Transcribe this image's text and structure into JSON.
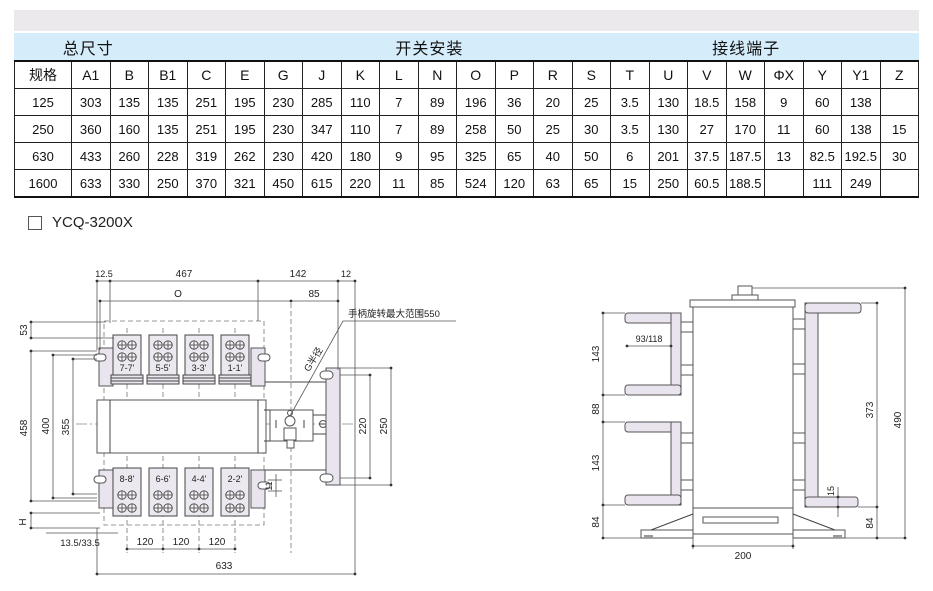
{
  "colors": {
    "header_band_blue": "#d5ecfb",
    "top_strip_gray": "#ece9ec",
    "drawing_fill_lavender": "#e9e4ee",
    "table_border": "#222222"
  },
  "table": {
    "groups": [
      "总尺寸",
      "开关安装",
      "接线端子"
    ],
    "columns": [
      "规格",
      "A1",
      "B",
      "B1",
      "C",
      "E",
      "G",
      "J",
      "K",
      "L",
      "N",
      "O",
      "P",
      "R",
      "S",
      "T",
      "U",
      "V",
      "W",
      "ΦX",
      "Y",
      "Y1",
      "Z"
    ],
    "rows": [
      [
        "125",
        "303",
        "135",
        "135",
        "251",
        "195",
        "230",
        "285",
        "110",
        "7",
        "89",
        "196",
        "36",
        "20",
        "25",
        "3.5",
        "130",
        "18.5",
        "158",
        "9",
        "60",
        "138",
        ""
      ],
      [
        "250",
        "360",
        "160",
        "135",
        "251",
        "195",
        "230",
        "347",
        "110",
        "7",
        "89",
        "258",
        "50",
        "25",
        "30",
        "3.5",
        "130",
        "27",
        "170",
        "11",
        "60",
        "138",
        "15"
      ],
      [
        "630",
        "433",
        "260",
        "228",
        "319",
        "262",
        "230",
        "420",
        "180",
        "9",
        "95",
        "325",
        "65",
        "40",
        "50",
        "6",
        "201",
        "37.5",
        "187.5",
        "13",
        "82.5",
        "192.5",
        "30"
      ],
      [
        "1600",
        "633",
        "330",
        "250",
        "370",
        "321",
        "450",
        "615",
        "220",
        "11",
        "85",
        "524",
        "120",
        "63",
        "65",
        "15",
        "250",
        "60.5",
        "188.5",
        "",
        "111",
        "249",
        ""
      ]
    ]
  },
  "model": {
    "label": "YCQ-3200X"
  },
  "front_drawing": {
    "dims": {
      "d12_5": "12.5",
      "d467": "467",
      "d142": "142",
      "d12": "12",
      "dO": "O",
      "d85": "85",
      "d53": "53",
      "d458": "458",
      "d400": "400",
      "d355": "355",
      "dH": "H",
      "d13_5_33_5": "13.5/33.5",
      "d120a": "120",
      "d120b": "120",
      "d120c": "120",
      "d633": "633",
      "d220": "220",
      "d250": "250",
      "d11": "11",
      "handle_note": "手柄旋转最大范围550",
      "g_radius": "G半径"
    },
    "terminals_top": [
      "7-7'",
      "5-5'",
      "3-3'",
      "1-1'"
    ],
    "terminals_bottom": [
      "8-8'",
      "6-6'",
      "4-4'",
      "2-2'"
    ]
  },
  "side_drawing": {
    "dims": {
      "d93_118": "93/118",
      "d143a": "143",
      "d88": "88",
      "d143b": "143",
      "d84a": "84",
      "d373": "373",
      "d490": "490",
      "d15": "15",
      "d84b": "84",
      "d200": "200"
    }
  }
}
